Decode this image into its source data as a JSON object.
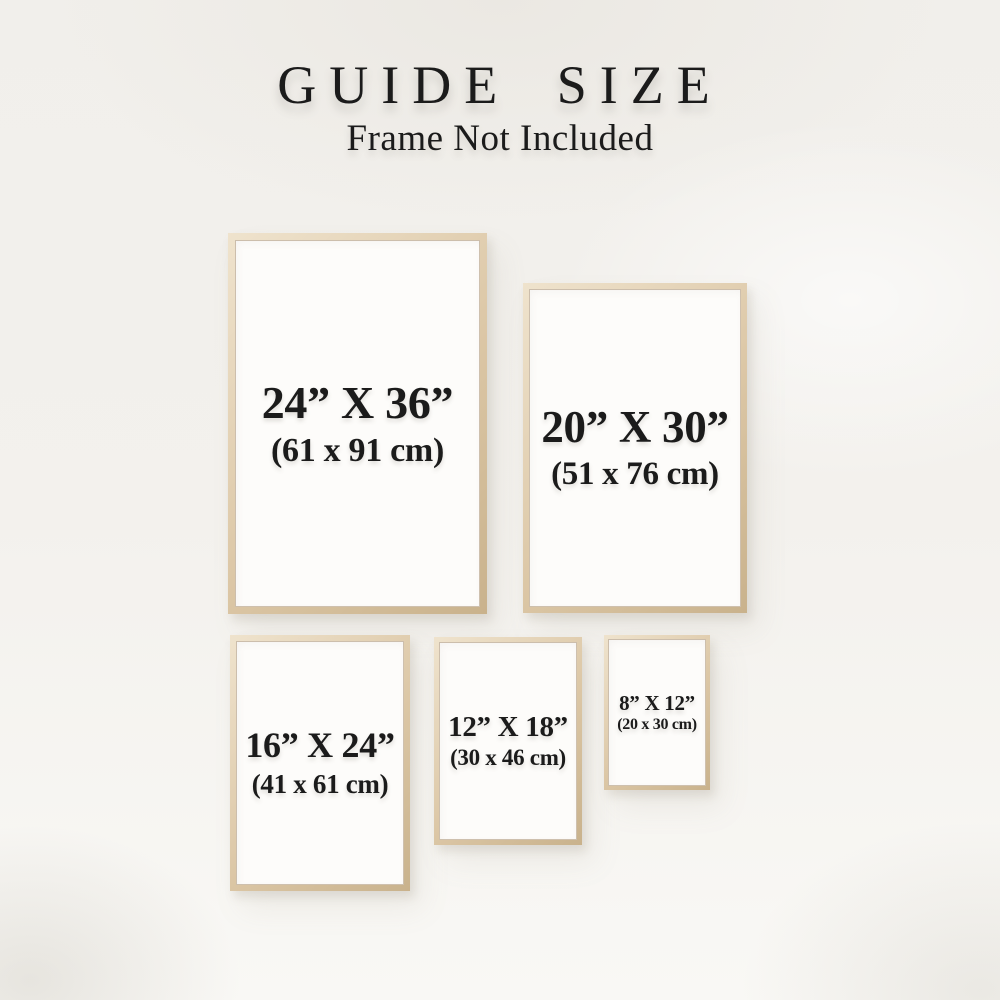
{
  "header": {
    "title": "GUIDE SIZE",
    "subtitle": "Frame Not Included"
  },
  "frames": [
    {
      "size_in": "24” X 36”",
      "size_cm": "(61 x 91 cm)"
    },
    {
      "size_in": "20” X 30”",
      "size_cm": "(51 x 76 cm)"
    },
    {
      "size_in": "16” X 24”",
      "size_cm": "(41 x 61 cm)"
    },
    {
      "size_in": "12” X 18”",
      "size_cm": "(30 x 46 cm)"
    },
    {
      "size_in": "8” X 12”",
      "size_cm": "(20 x 30 cm)"
    }
  ],
  "colors": {
    "background": "#f3f1ed",
    "frame_wood": "#d9c5a5",
    "frame_wood_dark": "#c9b28c",
    "frame_wood_light": "#efe3cd",
    "frame_interior": "#fdfcfa",
    "text": "#1b1b1b"
  }
}
